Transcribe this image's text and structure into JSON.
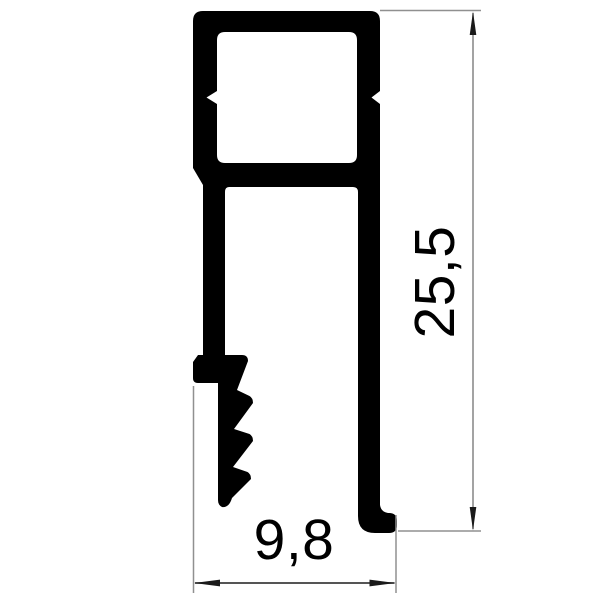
{
  "drawing": {
    "background_color": "#ffffff",
    "profile_color": "#000000",
    "extension_line_color": "#909090",
    "vertical_dimension_line_color": "#8c8c8c",
    "horizontal_dimension_line_color": "#3d3d3d",
    "arrow_color": "#1a1a1a",
    "text_color": "#000000",
    "dimensions": {
      "height": {
        "label": "25,5",
        "orientation": "vertical"
      },
      "width": {
        "label": "9,8",
        "orientation": "horizontal"
      }
    }
  }
}
